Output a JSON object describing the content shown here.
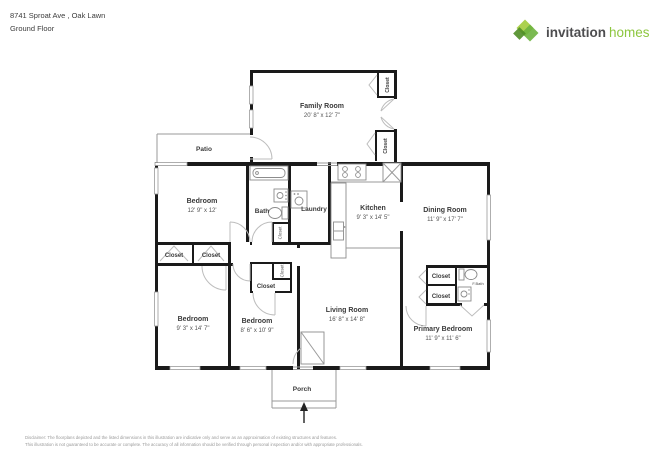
{
  "header": {
    "address": "8741 Sproat Ave , Oak Lawn",
    "floor": "Ground Floor"
  },
  "logo": {
    "word1": "invitation",
    "word2": "homes"
  },
  "colors": {
    "brand_green": "#8dc63f",
    "brand_green_dark": "#5d9732",
    "brand_text": "#4d4d4f",
    "wall_black": "#1a1a1a"
  },
  "labels": {
    "closet": "Closet",
    "full_bath": "F.Bath",
    "patio": "Patio",
    "porch": "Porch",
    "bath": "Bath",
    "laundry": "Laundry"
  },
  "rooms": {
    "family_room": {
      "name": "Family Room",
      "dims": "20' 8\" x 12' 7\""
    },
    "bedroom1": {
      "name": "Bedroom",
      "dims": "12' 9\" x 12'"
    },
    "kitchen": {
      "name": "Kitchen",
      "dims": "9' 3\" x 14' 5\""
    },
    "dining_room": {
      "name": "Dining Room",
      "dims": "11' 9\" x 17' 7\""
    },
    "bedroom2": {
      "name": "Bedroom",
      "dims": "9' 3\" x 14' 7\""
    },
    "bedroom3": {
      "name": "Bedroom",
      "dims": "8' 6\" x 10' 9\""
    },
    "living_room": {
      "name": "Living Room",
      "dims": "16' 8\" x 14' 8\""
    },
    "primary_bedroom": {
      "name": "Primary Bedroom",
      "dims": "11' 9\" x 11' 6\""
    }
  },
  "disclaimer": {
    "line1": "Disclaimer: The floorplans depicted and the listed dimensions in this illustration are indicative only and serve as an approximation of existing structures and features.",
    "line2": "This illustration is not guaranteed to be accurate or complete. The accuracy of all information should be verified through personal inspection and/or with appropriate professionals."
  }
}
